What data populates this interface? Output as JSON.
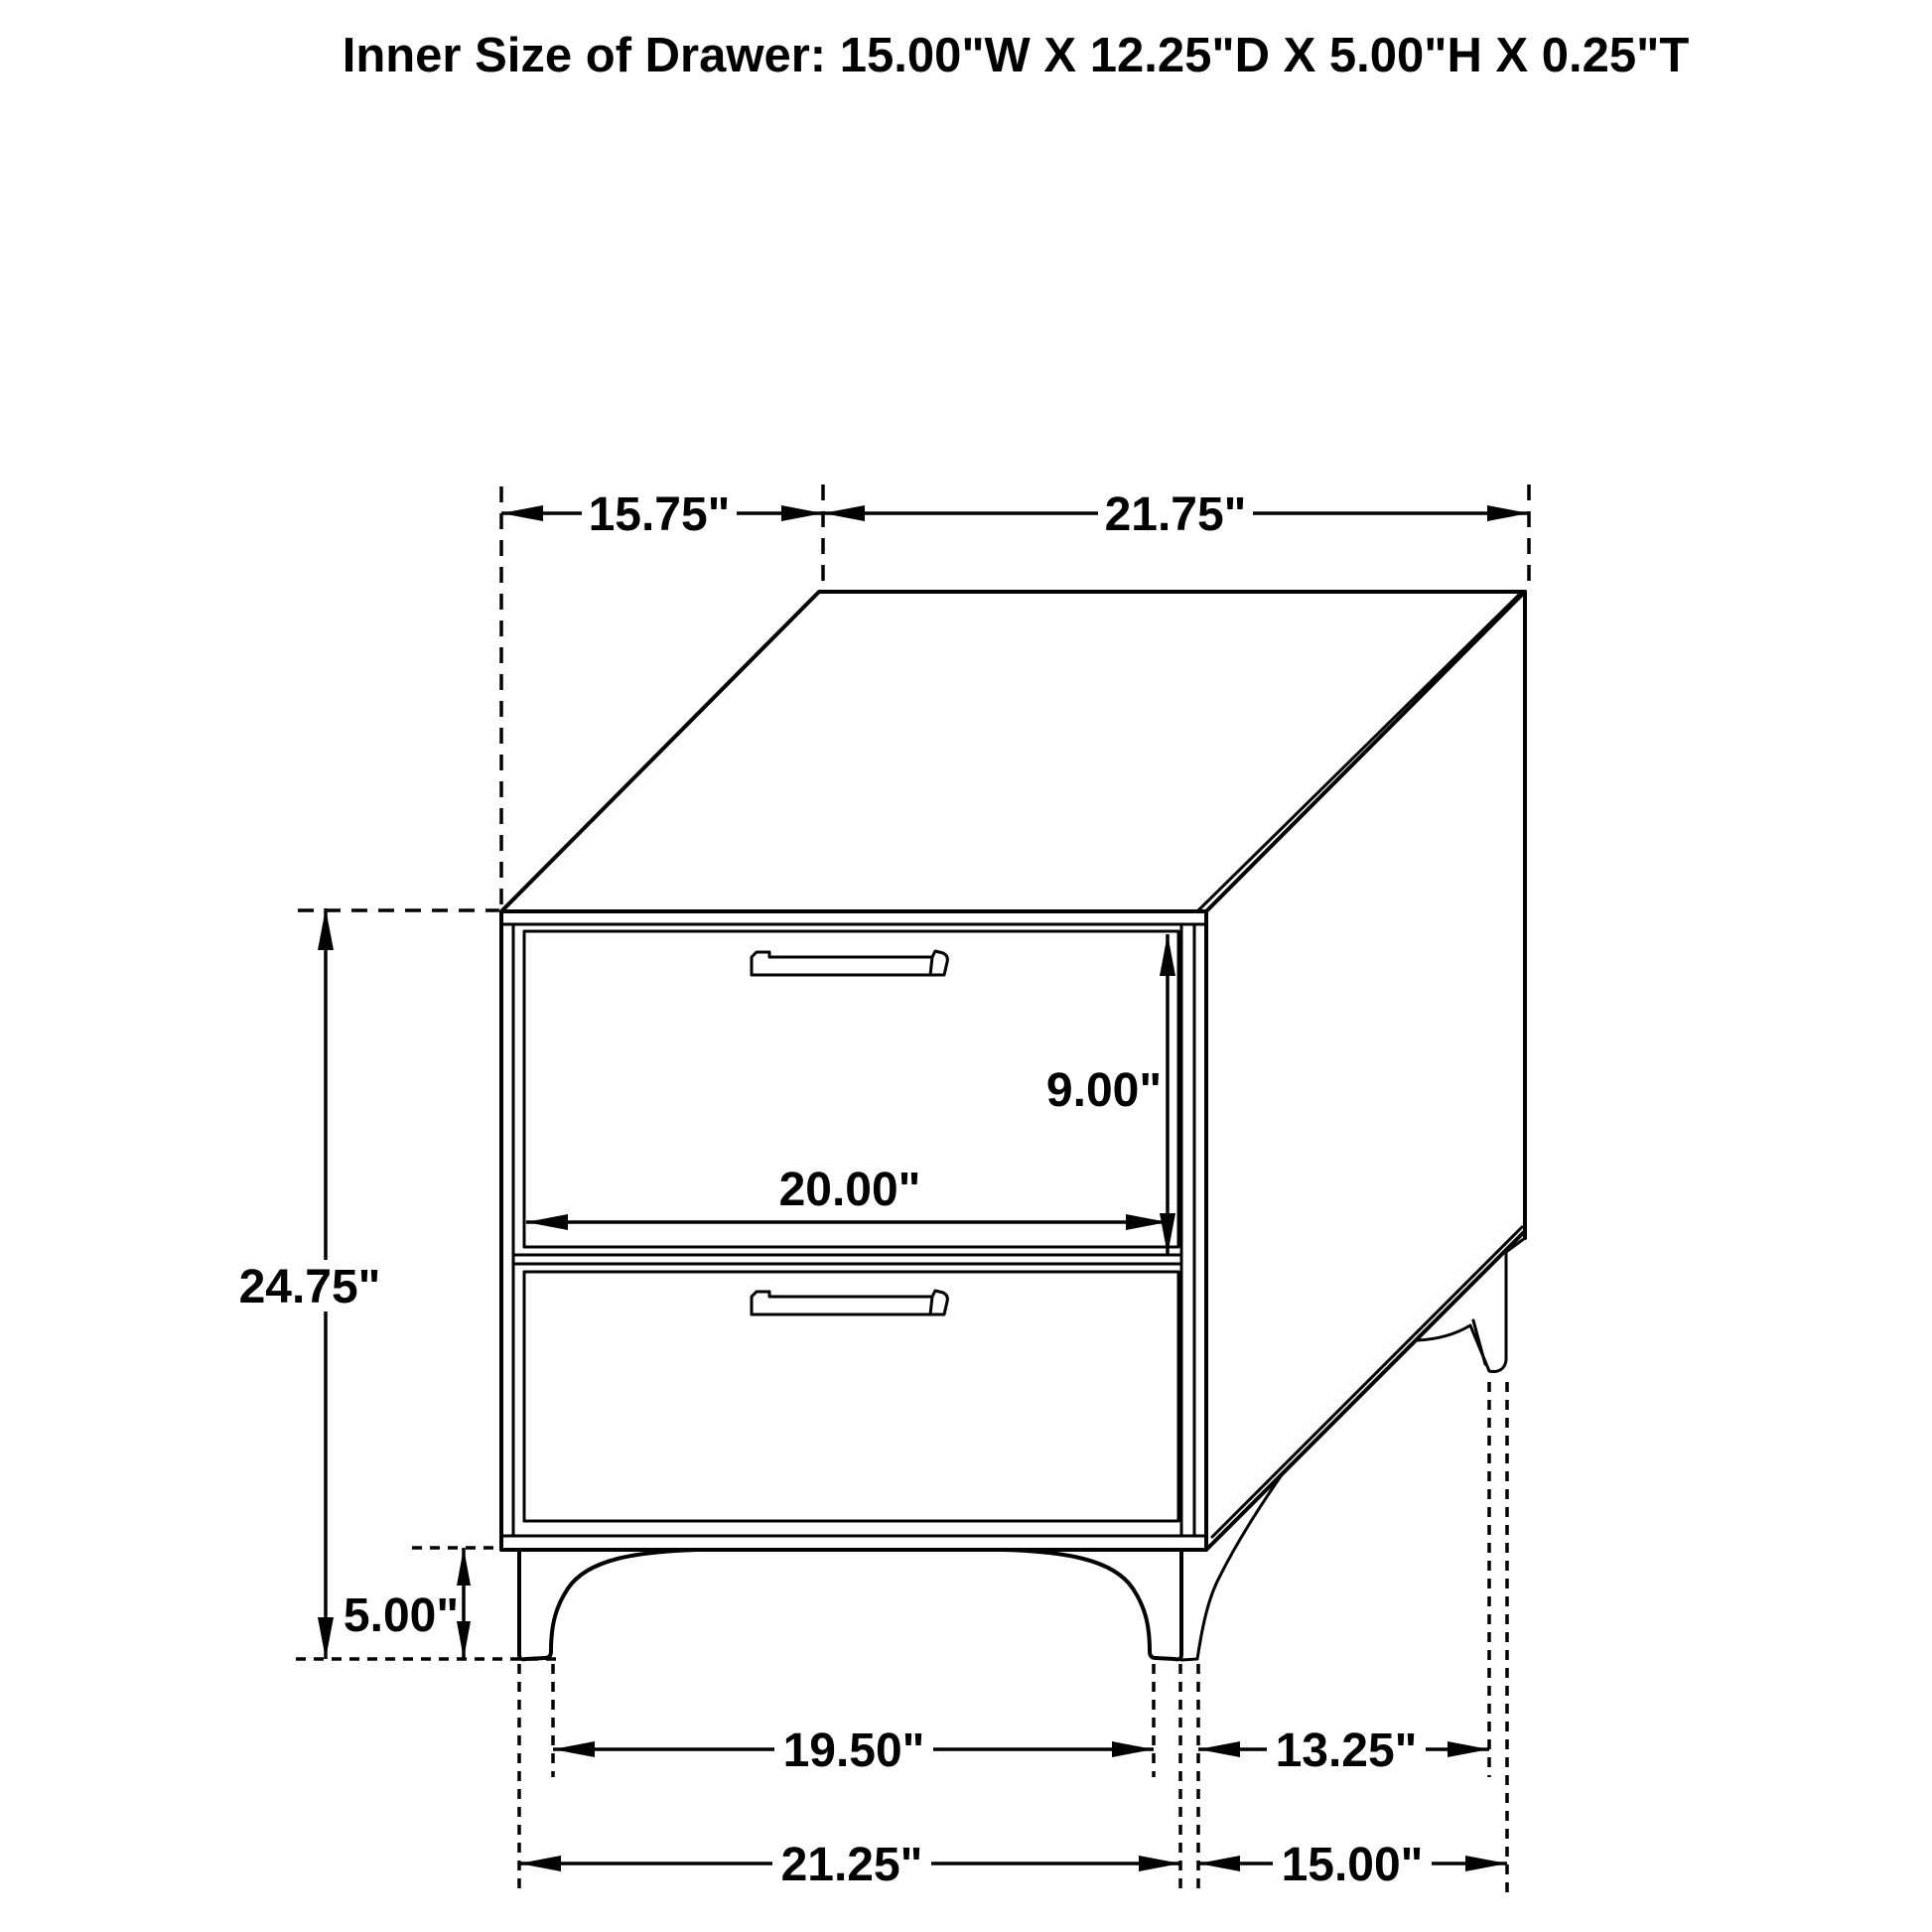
{
  "title": "Inner Size of Drawer: 15.00\"W X 12.25\"D X 5.00\"H X 0.25\"T",
  "dimensions": {
    "top_depth": "15.75\"",
    "top_width": "21.75\"",
    "drawer_front_height": "9.00\"",
    "drawer_front_width": "20.00\"",
    "overall_height": "24.75\"",
    "leg_height": "5.00\"",
    "front_leg_inner_span": "19.50\"",
    "side_leg_inner_span": "13.25\"",
    "front_leg_outer_span": "21.25\"",
    "side_leg_outer_span": "15.00\""
  },
  "colors": {
    "line": "#000000",
    "background": "#ffffff"
  }
}
